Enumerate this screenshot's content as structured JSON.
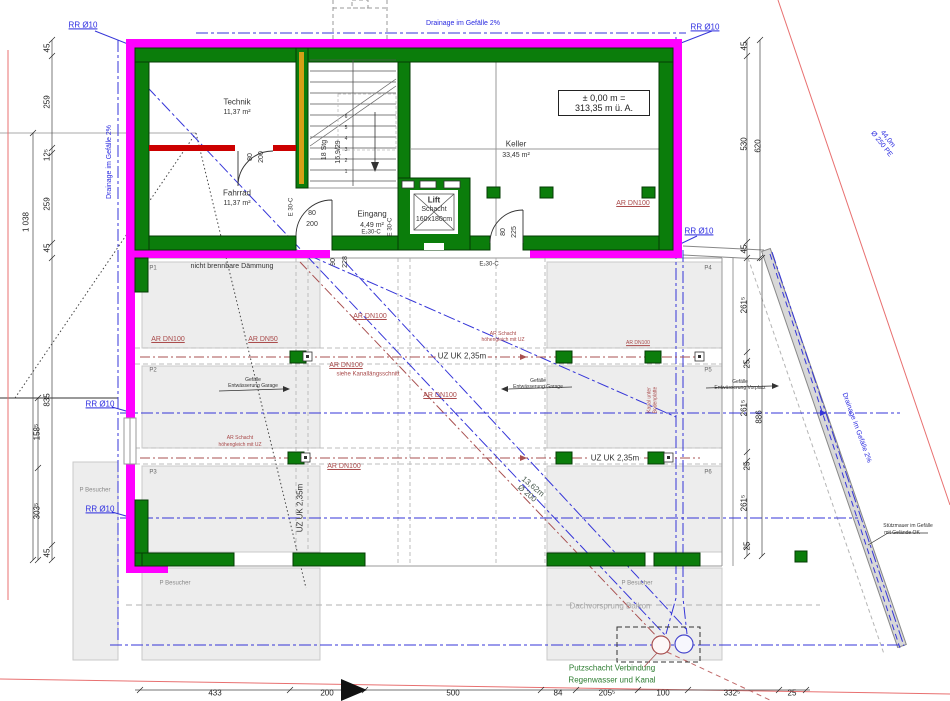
{
  "labels": {
    "rr10": "RR Ø10",
    "drainage": "Drainage im Gefälle 2%",
    "pipe44_l1": "44,0m",
    "pipe44_l2": "Ø 250 PE",
    "pipe13_l1": "13,62m",
    "pipe13_l2": "Ø 200",
    "insulation_note": "nicht brennbare Dämmung",
    "dachvorsprung": "Dachvorsprung Balkon",
    "putz_l1": "Putzschacht Verbindung",
    "putz_l2": "Regenwasser und Kanal",
    "stuetz_l1": "Stützmauer im Gefälle",
    "stuetz_l2": "mit Gelände OK"
  },
  "rooms": {
    "technik": {
      "name": "Technik",
      "area": "11,37 m²"
    },
    "fahrrad": {
      "name": "Fahrrad",
      "area": "11,37 m²"
    },
    "keller": {
      "name": "Keller",
      "area": "33,45 m²"
    },
    "eingang": {
      "name": "Eingang",
      "area": "4,49 m²"
    },
    "lift": {
      "l1": "Lift",
      "l2": "Schacht",
      "l3": "160x180cm"
    }
  },
  "level_box": {
    "l1": "± 0,00 m =",
    "l2": "313,35 m ü. A."
  },
  "stairs": {
    "stg": "18 Stg",
    "ratio": "16,9/29",
    "steps": [
      "1",
      "2",
      "3",
      "4",
      "5",
      "6"
    ]
  },
  "doors": {
    "w80": "80",
    "h200": "200",
    "w90": "90",
    "h228": "228",
    "h225": "225"
  },
  "fire_ratings": {
    "e30": "E 30-C",
    "e230": "E₂30-C"
  },
  "parking": {
    "p1": "P1",
    "p2": "P2",
    "p3": "P3",
    "p4": "P4",
    "p5": "P5",
    "p6": "P6",
    "besucher": "P Besucher"
  },
  "kanal": {
    "dn100": "AR DN100",
    "dn50": "AR DN50",
    "siehe": "siehe Kanallängsschnitt",
    "schacht_l1": "AR Schacht",
    "schacht_l2": "höhengleich mit UZ",
    "unter_l1": "Kanal unter",
    "unter_l2": "Bodenplatte",
    "uz": "UZ UK 2,35m"
  },
  "gefaelle": {
    "l1": "Gefälle",
    "garage": "Entwässerung Garage",
    "vorplatz": "Entwässerung Vorplatz"
  },
  "dims": {
    "bottom": [
      "433",
      "200",
      "500",
      "84",
      "205⁵",
      "100",
      "332⁵",
      "25"
    ],
    "left": [
      "45",
      "259",
      "12⁵",
      "259",
      "45"
    ],
    "left_total": "1 038",
    "left_lower": [
      "835",
      "158⁵",
      "303⁵",
      "45"
    ],
    "right": [
      "45",
      "530",
      "45"
    ],
    "right_total": "620",
    "right_lower": [
      "261⁵",
      "25",
      "261⁵",
      "25",
      "261⁵",
      "25"
    ],
    "right_lower_total": "886"
  },
  "colors": {
    "wall_green": "#0b7d0b",
    "insulation_magenta": "#ff00ff",
    "fire_red": "#cc0000",
    "drainage_blue": "#3535d8",
    "kanal_red": "#a85050",
    "note_green": "#2e7d32"
  }
}
